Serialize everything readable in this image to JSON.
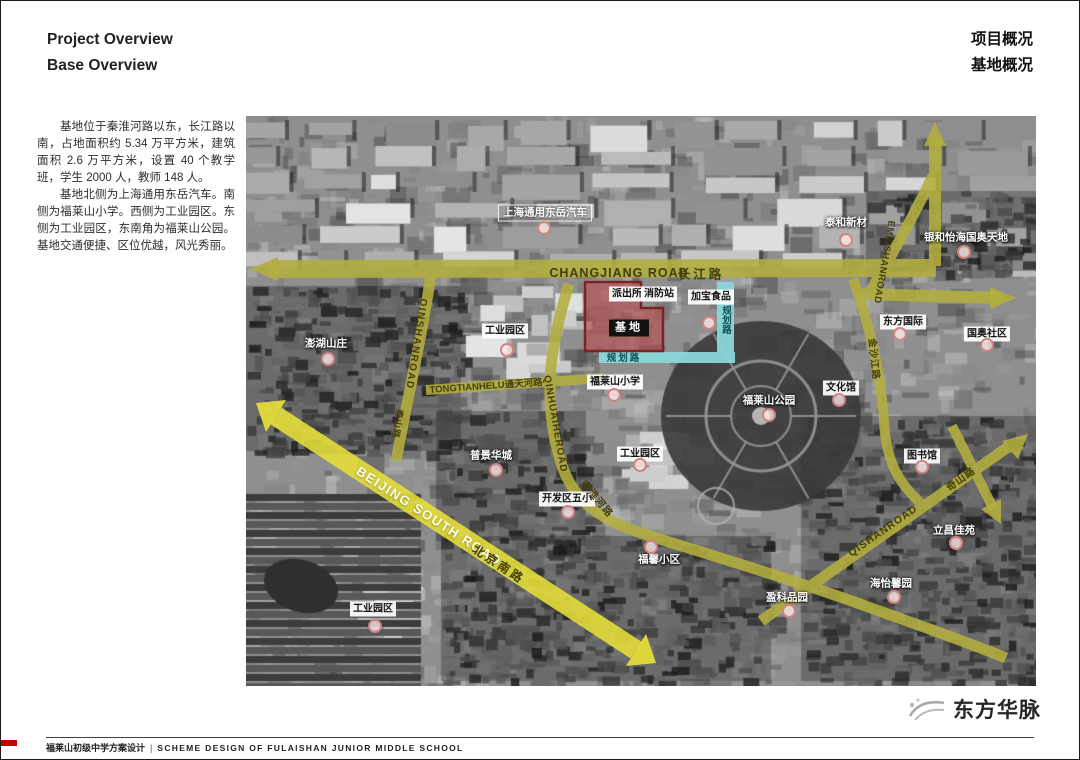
{
  "header": {
    "en_line1": "Project Overview",
    "en_line2": "Base Overview",
    "cn_line1": "项目概况",
    "cn_line2": "基地概况"
  },
  "description": {
    "para1": "基地位于秦淮河路以东，长江路以南，占地面积约 5.34 万平方米，建筑面积 2.6 万平方米，设置 40 个教学班，学生 2000 人，教师 148 人。",
    "para2": "基地北侧为上海通用东岳汽车。南侧为福莱山小学。西侧为工业园区。东侧为工业园区，东南角为福莱山公园。基地交通便捷、区位优越，风光秀丽。"
  },
  "footer": {
    "project_cn": "福莱山初级中学方案设计",
    "separator": "|",
    "project_en": "SCHEME DESIGN OF FULAISHAN JUNIOR MIDDLE SCHOOL",
    "logo_text": "东方华脉"
  },
  "map": {
    "colors": {
      "road_yellow": "#b3af3e",
      "road_bright_yellow": "#e8e138",
      "planned_road_cyan": "#8bd7da",
      "site_fill": "#bb4d4d",
      "site_border": "#7c2323",
      "pin_ring": "#ce7e7e"
    },
    "site_label": "基地",
    "place_labels": [
      {
        "text": "上海通用东岳汽车",
        "style": "outline",
        "x": 299,
        "y": 97,
        "pin": {
          "x": 298,
          "y": 112
        }
      },
      {
        "text": "泰和新材",
        "style": "plain",
        "x": 600,
        "y": 107,
        "pin": {
          "x": 600,
          "y": 124
        }
      },
      {
        "text": "银和怡海国奥天地",
        "style": "plain",
        "x": 720,
        "y": 122,
        "pin": {
          "x": 718,
          "y": 136
        }
      },
      {
        "text": "派出所",
        "style": "box",
        "x": 381,
        "y": 178
      },
      {
        "text": "消防站",
        "style": "box",
        "x": 413,
        "y": 178
      },
      {
        "text": "加宝食品",
        "style": "box",
        "x": 465,
        "y": 181,
        "pin": {
          "x": 463,
          "y": 207
        }
      },
      {
        "text": "基地",
        "style": "dark",
        "x": 383,
        "y": 212
      },
      {
        "text": "工业园区",
        "style": "box",
        "x": 259,
        "y": 215,
        "pin": {
          "x": 261,
          "y": 234
        }
      },
      {
        "text": "澎湖山庄",
        "style": "plain",
        "x": 80,
        "y": 228,
        "pin": {
          "x": 82,
          "y": 243
        }
      },
      {
        "text": "东方国际",
        "style": "box",
        "x": 657,
        "y": 206,
        "pin": {
          "x": 654,
          "y": 218
        }
      },
      {
        "text": "国奥社区",
        "style": "box",
        "x": 741,
        "y": 218,
        "pin": {
          "x": 741,
          "y": 229
        }
      },
      {
        "text": "福莱山小学",
        "style": "box",
        "x": 369,
        "y": 266,
        "pin": {
          "x": 368,
          "y": 279
        }
      },
      {
        "text": "文化馆",
        "style": "box",
        "x": 595,
        "y": 272,
        "pin": {
          "x": 593,
          "y": 284
        }
      },
      {
        "text": "福莱山公园",
        "style": "plain",
        "x": 523,
        "y": 285,
        "pin": {
          "x": 523,
          "y": 299
        }
      },
      {
        "text": "工业园区",
        "style": "box",
        "x": 394,
        "y": 338,
        "pin": {
          "x": 394,
          "y": 349
        }
      },
      {
        "text": "图书馆",
        "style": "box",
        "x": 676,
        "y": 340,
        "pin": {
          "x": 676,
          "y": 351
        }
      },
      {
        "text": "普景华城",
        "style": "plain",
        "x": 245,
        "y": 340,
        "pin": {
          "x": 250,
          "y": 354
        }
      },
      {
        "text": "开发区五小",
        "style": "box",
        "x": 321,
        "y": 383,
        "pin": {
          "x": 322,
          "y": 396
        }
      },
      {
        "text": "立昌佳苑",
        "style": "plain",
        "x": 708,
        "y": 415,
        "pin": {
          "x": 710,
          "y": 427
        }
      },
      {
        "text": "福馨小区",
        "style": "plain",
        "x": 413,
        "y": 444,
        "pin": {
          "x": 405,
          "y": 431
        }
      },
      {
        "text": "海怡馨园",
        "style": "plain",
        "x": 645,
        "y": 468,
        "pin": {
          "x": 648,
          "y": 481
        }
      },
      {
        "text": "盈科品园",
        "style": "plain",
        "x": 541,
        "y": 482,
        "pin": {
          "x": 543,
          "y": 495
        }
      },
      {
        "text": "工业园区",
        "style": "box",
        "x": 127,
        "y": 493,
        "pin": {
          "x": 129,
          "y": 510
        }
      }
    ],
    "road_labels": [
      {
        "text": "CHANGJIANG ROAD",
        "x": 373,
        "y": 157,
        "rot": 0,
        "style": "dark",
        "size": 12.5,
        "ls": 1
      },
      {
        "text": "长江路",
        "x": 455,
        "y": 157,
        "rot": 0,
        "style": "dark",
        "size": 12.5,
        "ls": 3
      },
      {
        "text": "QINSHANROAD",
        "x": 170,
        "y": 228,
        "rot": 99,
        "style": "dark",
        "size": 10,
        "ls": 1.5
      },
      {
        "text": "秦山路",
        "x": 152,
        "y": 308,
        "rot": 99,
        "style": "dark",
        "size": 9,
        "ls": 1
      },
      {
        "text": "TONGTIANHELU通天河路",
        "x": 240,
        "y": 269,
        "rot": -4,
        "style": "dark",
        "size": 9.5,
        "ls": 0
      },
      {
        "text": "BEIJING SOUTH ROAD",
        "x": 183,
        "y": 400,
        "rot": 33,
        "style": "light",
        "size": 13,
        "ls": 1.5
      },
      {
        "text": "北京南路",
        "x": 253,
        "y": 448,
        "rot": 33,
        "style": "dark",
        "size": 12,
        "ls": 3
      },
      {
        "text": "QINHUAIHEROAD",
        "x": 309,
        "y": 308,
        "rot": 80,
        "style": "dark",
        "size": 10,
        "ls": 1
      },
      {
        "text": "秦淮河路",
        "x": 352,
        "y": 382,
        "rot": 50,
        "style": "dark",
        "size": 10,
        "ls": 1
      },
      {
        "text": "EMEISHANROAD",
        "x": 638,
        "y": 146,
        "rot": 100,
        "style": "dark",
        "size": 9.5,
        "ls": 0.5
      },
      {
        "text": "金沙江路",
        "x": 629,
        "y": 243,
        "rot": 84,
        "style": "dark",
        "size": 9.5,
        "ls": 1
      },
      {
        "text": "QISHANROAD",
        "x": 637,
        "y": 415,
        "rot": -35,
        "style": "dark",
        "size": 10.5,
        "ls": 1
      },
      {
        "text": "奇山路",
        "x": 714,
        "y": 362,
        "rot": -35,
        "style": "dark",
        "size": 10,
        "ls": 1
      },
      {
        "text": "规划路",
        "x": 479,
        "y": 204,
        "rot": 0,
        "style": "teal",
        "size": 9.5,
        "vertical": true,
        "ls": 0
      },
      {
        "text": "规划路",
        "x": 378,
        "y": 241,
        "rot": 0,
        "style": "teal",
        "size": 9.5,
        "ls": 2
      }
    ]
  }
}
